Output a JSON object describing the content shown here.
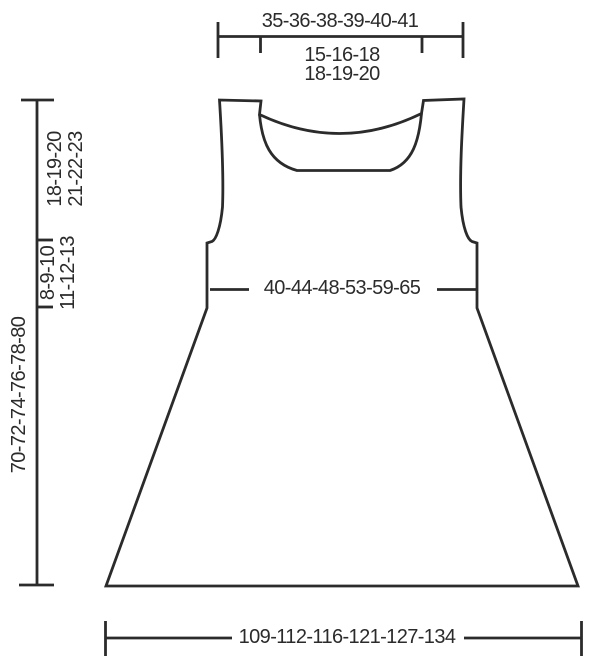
{
  "diagram_type": "garment-schematic",
  "colors": {
    "line": "#2b2b2b",
    "background": "#ffffff"
  },
  "labels": {
    "top_width": "35-36-38-39-40-41",
    "neck_row1": "15-16-18",
    "neck_row2": "18-19-20",
    "yoke_depth_row1": "18-19-20",
    "yoke_depth_row2": "21-22-23",
    "armhole_section_row1": "8-9-10",
    "armhole_section_row2": "11-12-13",
    "total_length": "70-72-74-76-78-80",
    "bust_width": "40-44-48-53-59-65",
    "hem_width": "109-112-116-121-127-134"
  }
}
